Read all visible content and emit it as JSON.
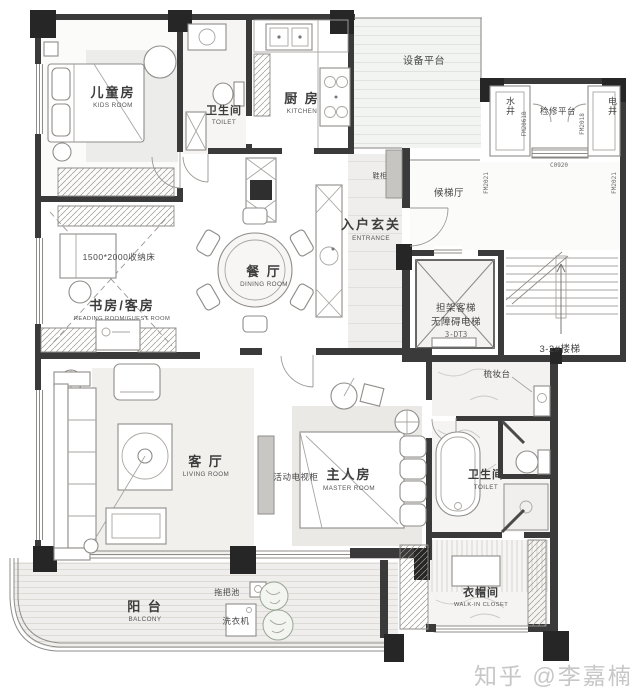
{
  "rooms": {
    "kids": {
      "zh": "儿童房",
      "en": "KIDS ROOM"
    },
    "bath1": {
      "zh": "卫生间",
      "en": "TOILET"
    },
    "kitchen": {
      "zh": "厨 房",
      "en": "KITCHEN"
    },
    "equipment": {
      "zh": "设备平台"
    },
    "water_shaft": {
      "zh": "水井"
    },
    "inspection": {
      "zh": "检修平台"
    },
    "elec_shaft": {
      "zh": "电井"
    },
    "lift_hall": {
      "zh": "候梯厅"
    },
    "entrance": {
      "zh": "入户玄关",
      "en": "ENTRANCE"
    },
    "dining": {
      "zh": "餐 厅",
      "en": "DINING ROOM"
    },
    "study": {
      "zh": "书房/客房",
      "en": "READING ROOM/GUEST ROOM"
    },
    "living": {
      "zh": "客 厅",
      "en": "LIVING ROOM"
    },
    "master": {
      "zh": "主人房",
      "en": "MASTER ROOM"
    },
    "bath2": {
      "zh": "卫生间",
      "en": "TOILET"
    },
    "closet": {
      "zh": "衣帽间",
      "en": "WALK-IN CLOSET"
    },
    "balcony": {
      "zh": "阳 台",
      "en": "BALCONY"
    }
  },
  "fixtures": {
    "storage_bed": "1500*2000收纳床",
    "tv_cabinet": "活动电视柜",
    "shoe_cabinet": "鞋柜",
    "dresser": "梳妆台",
    "washer": "洗衣机",
    "mop_sink": "拖把池",
    "lift_l1": "担架客梯",
    "lift_l2": "无障碍电梯",
    "lift_l3": "3-DT3",
    "stairs": "3-2#楼梯"
  },
  "codes": {
    "c1": "FM2061B",
    "c2": "FM2018",
    "c3": "C0920",
    "c4": "FM2021",
    "c5": "FM2021"
  },
  "watermark": "知乎 @李嘉楠",
  "colors": {
    "wall": "#3a3a3a",
    "floor_tint": "#efeeec",
    "hatch_line": "#9a9890"
  }
}
